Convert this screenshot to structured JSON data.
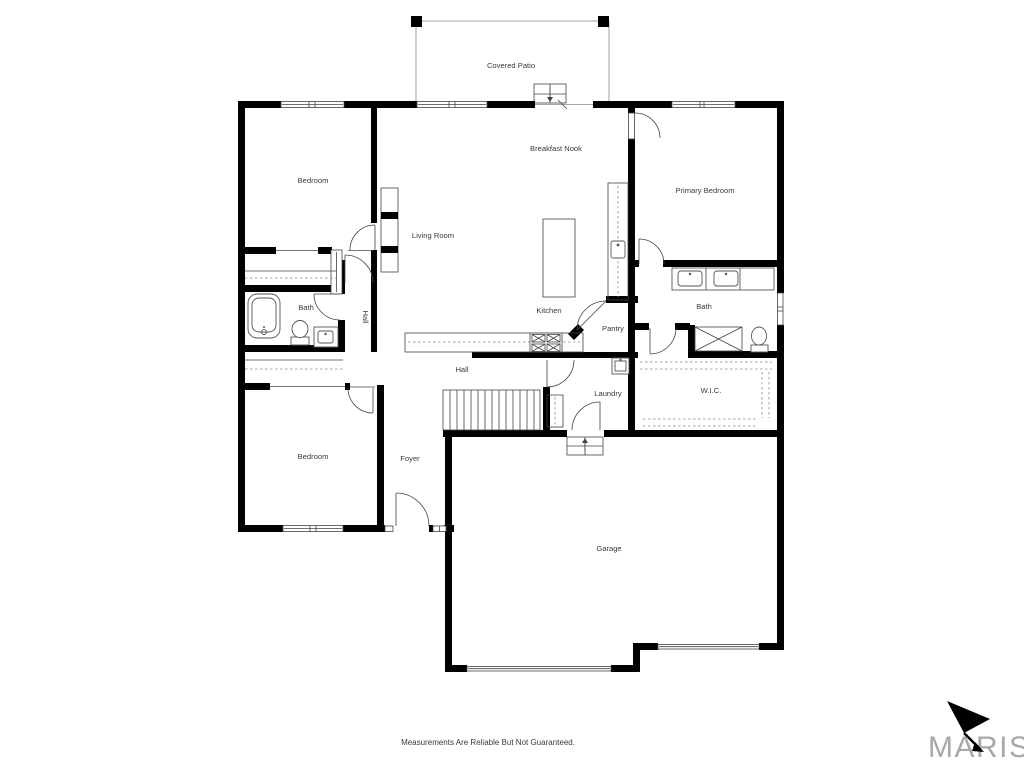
{
  "rooms": [
    {
      "id": "covered-patio",
      "label": "Covered Patio"
    },
    {
      "id": "breakfast-nook",
      "label": "Breakfast Nook"
    },
    {
      "id": "bedroom-top",
      "label": "Bedroom"
    },
    {
      "id": "primary-bedroom",
      "label": "Primary Bedroom"
    },
    {
      "id": "living-room",
      "label": "Living Room"
    },
    {
      "id": "bath-left",
      "label": "Bath"
    },
    {
      "id": "hall-left",
      "label": "Hall"
    },
    {
      "id": "kitchen",
      "label": "Kitchen"
    },
    {
      "id": "pantry",
      "label": "Pantry"
    },
    {
      "id": "bath-primary",
      "label": "Bath"
    },
    {
      "id": "hall-center",
      "label": "Hall"
    },
    {
      "id": "laundry",
      "label": "Laundry"
    },
    {
      "id": "wic",
      "label": "W.I.C."
    },
    {
      "id": "bedroom-bottom",
      "label": "Bedroom"
    },
    {
      "id": "foyer",
      "label": "Foyer"
    },
    {
      "id": "garage",
      "label": "Garage"
    }
  ],
  "footer": {
    "disclaimer": "Measurements Are Reliable But Not Guaranteed."
  },
  "brand": {
    "name": "MARIS"
  },
  "colors": {
    "wall": "#000000",
    "label_text": "#3a3a3a",
    "thin_line": "#555555",
    "brand_gray": "#a8a8a8"
  }
}
